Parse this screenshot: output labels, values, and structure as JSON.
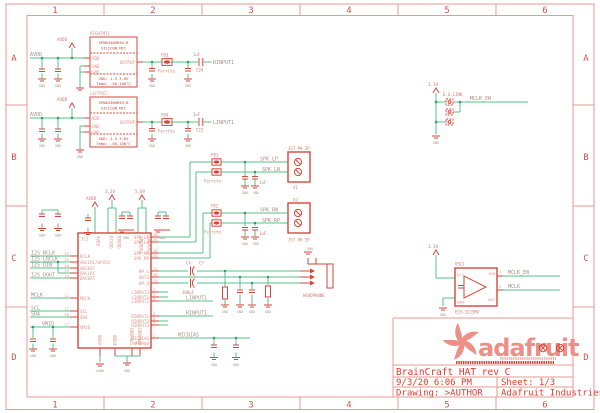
{
  "frame": {
    "cols": [
      "1",
      "2",
      "3",
      "4",
      "5",
      "6"
    ],
    "rows": [
      "A",
      "B",
      "C",
      "D"
    ]
  },
  "power": {
    "avdd": "AVDD",
    "v33": "3.3V",
    "v50": "5.0V",
    "gnd": "GND",
    "agnd": "AGND"
  },
  "mics": {
    "right": {
      "name": "RIGHTMIC",
      "part1": "SPW0430HR5H-B",
      "part2": "SILICON MIC",
      "pin_vdd": "VDD",
      "pin_gnd1": "GND",
      "pin_gnd2": "GND",
      "pin_out": "OUTPUT",
      "note1": "VDD: 1.5-3.6V",
      "note2": "Temp: -40-100°C",
      "fb": "FB3",
      "fb_value": "Ferrite",
      "cap": "C24",
      "cap_value": "1uF",
      "net_out": "RINPUT1"
    },
    "left": {
      "name": "LEFTMIC",
      "part1": "SPW0430HR5H-B",
      "part2": "SILICON MIC",
      "pin_vdd": "VDD",
      "pin_gnd1": "GND",
      "pin_gnd2": "GND",
      "pin_out": "OUTPUT",
      "note1": "VDD: 1.5-3.6V",
      "note2": "Temp: -40-100°C",
      "fb": "FB4",
      "fb_value": "Ferrite",
      "cap": "C23",
      "cap_value": "1uF",
      "net_out": "LINPUT1"
    }
  },
  "ic3": {
    "designator": "IC3",
    "part": "WM8960",
    "left_pins": [
      {
        "num": "12",
        "name": "BCLK"
      },
      {
        "num": "15",
        "name": "ADCLRC/GPIO1"
      },
      {
        "num": "16",
        "name": "ADCDAT"
      },
      {
        "num": "13",
        "name": "DACLRC"
      },
      {
        "num": "14",
        "name": "DACDAT"
      },
      {
        "num": "11",
        "name": "MCLK"
      },
      {
        "num": "17",
        "name": "SCL"
      },
      {
        "num": "18",
        "name": "SDA"
      },
      {
        "num": "27",
        "name": "VMID"
      }
    ],
    "left_nets": {
      "bclk": "I2S_BCLK",
      "lrclk": "I2S_LRCLK",
      "din": "I2S_DIN",
      "dout": "I2S_DOUT",
      "mclk": "MCLK",
      "scl": "SCL",
      "sda": "SDA",
      "vmid": "VMID"
    },
    "top_pins": [
      "AVDD",
      "DCVDD",
      "DBVDD",
      "SPKVDD1",
      "SPKVDD2"
    ],
    "bottom_pins": [
      "AGND",
      "DGND",
      "SPKGND1",
      "SPKGND2"
    ],
    "right_pins": [
      {
        "num": "26",
        "name": "SPK_LP"
      },
      {
        "num": "25",
        "name": "SPK_LN"
      },
      {
        "num": "28",
        "name": "SPK_RN"
      },
      {
        "num": "22",
        "name": "SPK_RP"
      },
      {
        "num": "21",
        "name": "HP_L"
      },
      {
        "num": "20",
        "name": "OUT3"
      },
      {
        "num": "23",
        "name": "HP_R"
      },
      {
        "num": "2",
        "name": "LINPUT3"
      },
      {
        "num": "3",
        "name": "LINPUT2"
      },
      {
        "num": "4",
        "name": "LINPUT1"
      },
      {
        "num": "5",
        "name": "RINPUT1"
      },
      {
        "num": "6",
        "name": "RINPUT2"
      },
      {
        "num": "7",
        "name": "RINPUT3"
      },
      {
        "num": "1",
        "name": "MICBIAS"
      }
    ]
  },
  "nets": {
    "linput1": "LINPUT1",
    "rinput1": "RINPUT1",
    "micbias": "MICBIAS",
    "mclk": "MCLK",
    "mclk_en": "MCLK_EN",
    "spk_lp": "SPK_LP",
    "spk_ln": "SPK_LN",
    "spk_rn": "SPK_RN",
    "spk_rp": "SPK_RP"
  },
  "speaker": {
    "x1": "X1",
    "x2": "X2",
    "part": "JST PH 2P",
    "fb1": "FB1",
    "fb2": "FB2",
    "ferrite": "Ferrite",
    "cap_value": "1uF"
  },
  "headphone": {
    "label": "HEADPHONE",
    "c_left": "C4",
    "c_left_value": "100uF",
    "c_right": "C7",
    "c_right_value": "100uF"
  },
  "jumper": {
    "label": "E.G.LINK",
    "net": "MCLK_EN",
    "v": "3.3V"
  },
  "osc": {
    "designator": "OSC1",
    "part": "ECS-3225MV",
    "pin_vcc": "VCC",
    "pin_gnd": "GND",
    "pin_inh": "INH",
    "pin_out": "OUT",
    "num_inh": "1",
    "num_out": "3"
  },
  "logo": {
    "wordmark": "adafruit"
  },
  "title_block": {
    "title": "BrainCraft HAT rev C",
    "date": "9/3/20 6:06 PM",
    "sheet": "Sheet: 1/3",
    "drawing": "Drawing: >AUTHOR",
    "company": "Adafruit Industries"
  }
}
